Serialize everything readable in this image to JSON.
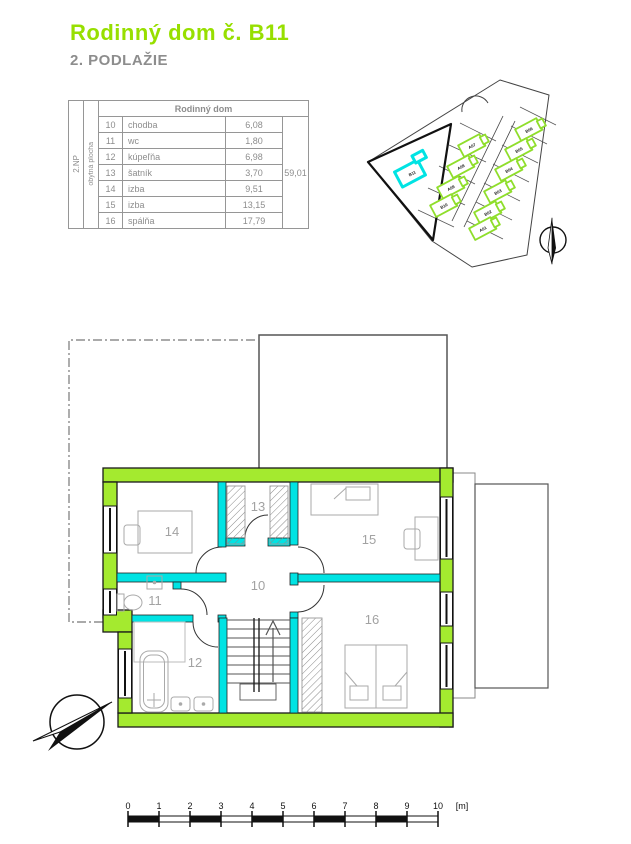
{
  "page": {
    "title": "Rodinný dom č. B11",
    "subtitle": "2. PODLAŽIE"
  },
  "table": {
    "title": "Rodinný dom",
    "floor_label": "2.NP",
    "area_label": "obytná plocha",
    "rows": [
      {
        "no": "10",
        "name": "chodba",
        "area": "6,08"
      },
      {
        "no": "11",
        "name": "wc",
        "area": "1,80"
      },
      {
        "no": "12",
        "name": "kúpeľňa",
        "area": "6,98"
      },
      {
        "no": "13",
        "name": "šatník",
        "area": "3,70"
      },
      {
        "no": "14",
        "name": "izba",
        "area": "9,51"
      },
      {
        "no": "15",
        "name": "izba",
        "area": "13,15"
      },
      {
        "no": "16",
        "name": "spálňa",
        "area": "17,79"
      }
    ],
    "total": "59,01"
  },
  "site_plan": {
    "houses": [
      "A07",
      "A08",
      "A09",
      "B10",
      "B06",
      "B05",
      "B04",
      "B03",
      "B02",
      "A01"
    ],
    "highlighted": "B11",
    "house_color": "#8FDE2B",
    "highlight_color": "#00E3E3"
  },
  "floor_plan": {
    "rooms": [
      "10",
      "11",
      "12",
      "13",
      "14",
      "15",
      "16"
    ],
    "wall_color": "#A4EA2F",
    "partition_color": "#00E3E3"
  },
  "scale_bar": {
    "ticks": [
      "0",
      "1",
      "2",
      "3",
      "4",
      "5",
      "6",
      "7",
      "8",
      "9",
      "10"
    ],
    "unit": "[m]"
  }
}
